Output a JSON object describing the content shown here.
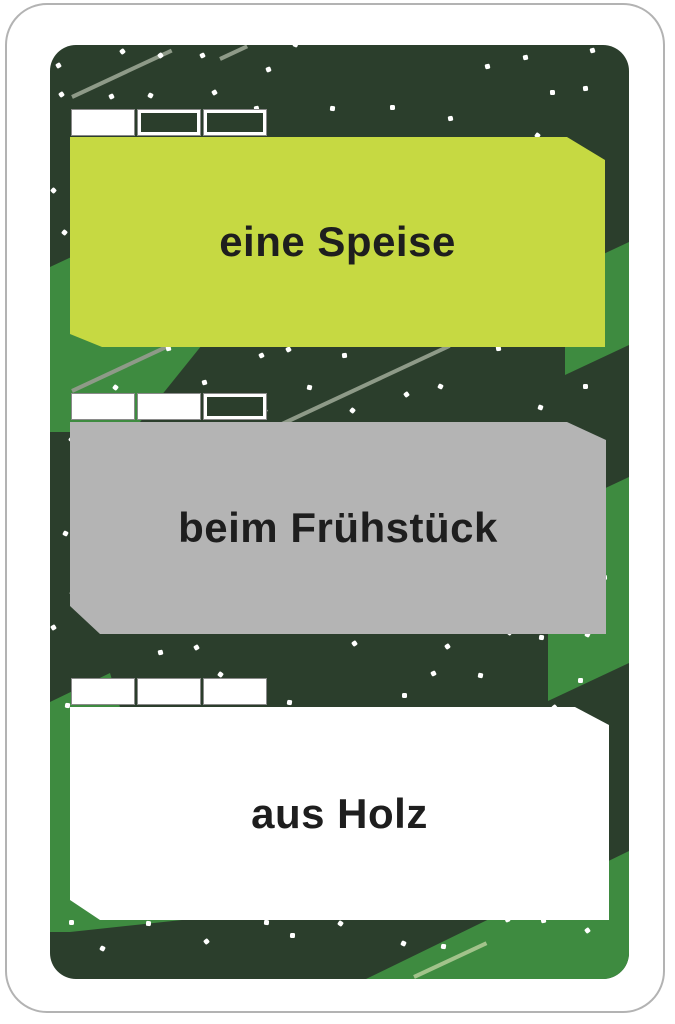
{
  "card": {
    "kind": "word-game-card",
    "panels": [
      {
        "label": "eine Speise",
        "bg": "#c6d942",
        "tabs": [
          "filled",
          "empty",
          "empty"
        ]
      },
      {
        "label": "beim Frühstück",
        "bg": "#b4b4b4",
        "tabs": [
          "filled",
          "filled",
          "empty"
        ]
      },
      {
        "label": "aus Holz",
        "bg": "#ffffff",
        "tabs": [
          "filled",
          "filled",
          "filled"
        ]
      }
    ],
    "colors": {
      "art_background": "#2b3e2c",
      "accent_green": "#3e8b40",
      "line_olive": "#8e9a88",
      "line_light_green": "#a2c38b",
      "label_text": "#1e1e1e",
      "card_border": "#b3b3b3",
      "confetti_dot": "#ffffff"
    }
  }
}
